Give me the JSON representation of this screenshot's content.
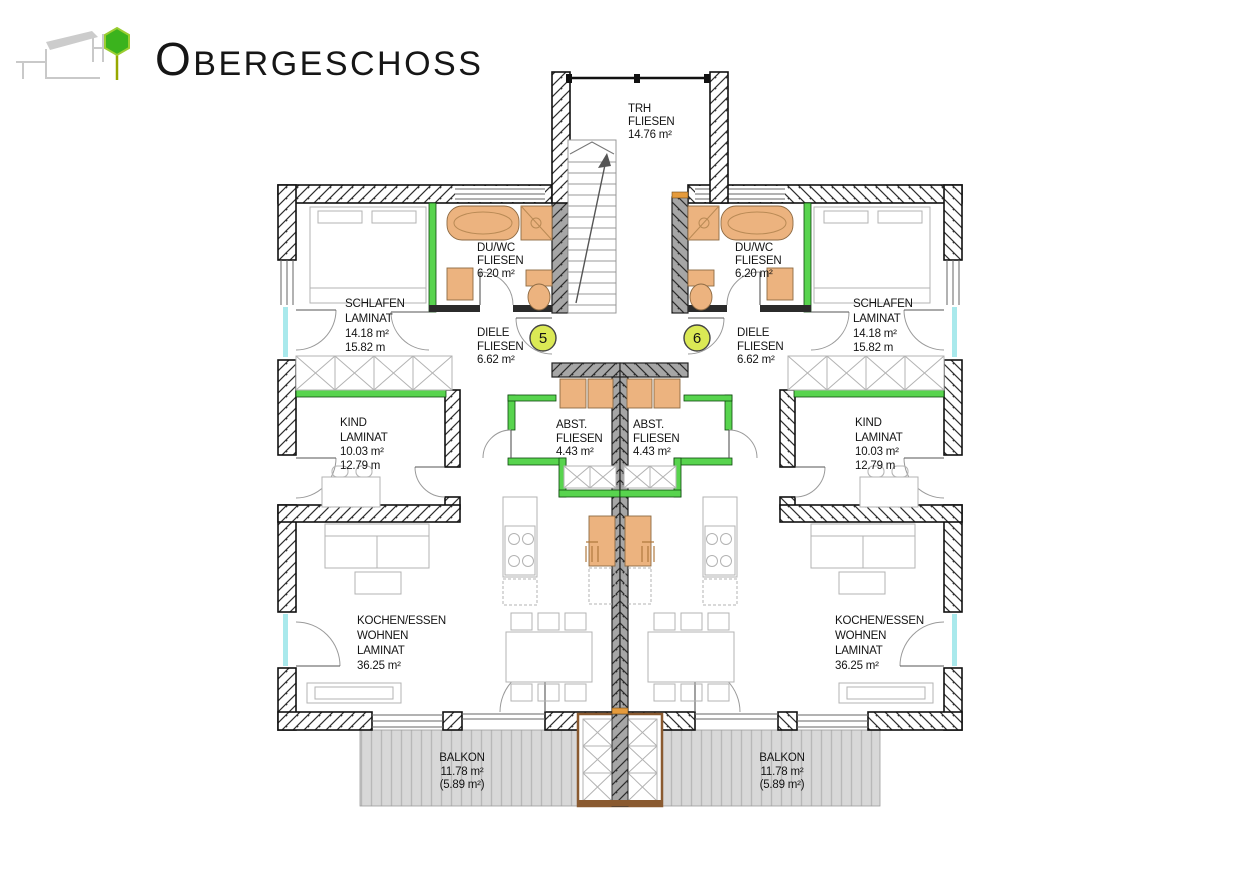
{
  "header": {
    "title_initial": "O",
    "title_rest": "BERGESCHOSS"
  },
  "stairwell": {
    "label_lines": [
      "TRH",
      "FLIESEN",
      "14.76 m²"
    ]
  },
  "apartments": [
    {
      "unit": "5",
      "schlafen": [
        "SCHLAFEN",
        "LAMINAT",
        "14.18 m²",
        "15.82 m"
      ],
      "duwc": [
        "DU/WC",
        "FLIESEN",
        "6.20 m²"
      ],
      "diele": [
        "DIELE",
        "FLIESEN",
        "6.62 m²"
      ],
      "kind": [
        "KIND",
        "LAMINAT",
        "10.03 m²",
        "12.79 m"
      ],
      "abst": [
        "ABST.",
        "FLIESEN",
        "4.43 m²"
      ],
      "wohnen": [
        "KOCHEN/ESSEN",
        "WOHNEN",
        "LAMINAT",
        "36.25 m²"
      ],
      "balkon": [
        "BALKON",
        "11.78 m²",
        "(5.89 m²)"
      ]
    },
    {
      "unit": "6",
      "schlafen": [
        "SCHLAFEN",
        "LAMINAT",
        "14.18 m²",
        "15.82 m"
      ],
      "duwc": [
        "DU/WC",
        "FLIESEN",
        "6.20 m²"
      ],
      "diele": [
        "DIELE",
        "FLIESEN",
        "6.62 m²"
      ],
      "kind": [
        "KIND",
        "LAMINAT",
        "10.03 m²",
        "12.79 m"
      ],
      "abst": [
        "ABST.",
        "FLIESEN",
        "4.43 m²"
      ],
      "wohnen": [
        "KOCHEN/ESSEN",
        "WOHNEN",
        "LAMINAT",
        "36.25 m²"
      ],
      "balkon": [
        "BALKON",
        "11.78 m²",
        "(5.89 m²)"
      ]
    }
  ],
  "colors": {
    "insulation_green": "#58d44e",
    "fixture_orange": "#ecb37f",
    "unit_badge": "#dbe955",
    "wall_gray": "#a6a6a6",
    "deck_gray": "#d8d8d8",
    "balcony_wood_brown": "#8a5a30",
    "logo_tree_green": "#3bb31d"
  }
}
